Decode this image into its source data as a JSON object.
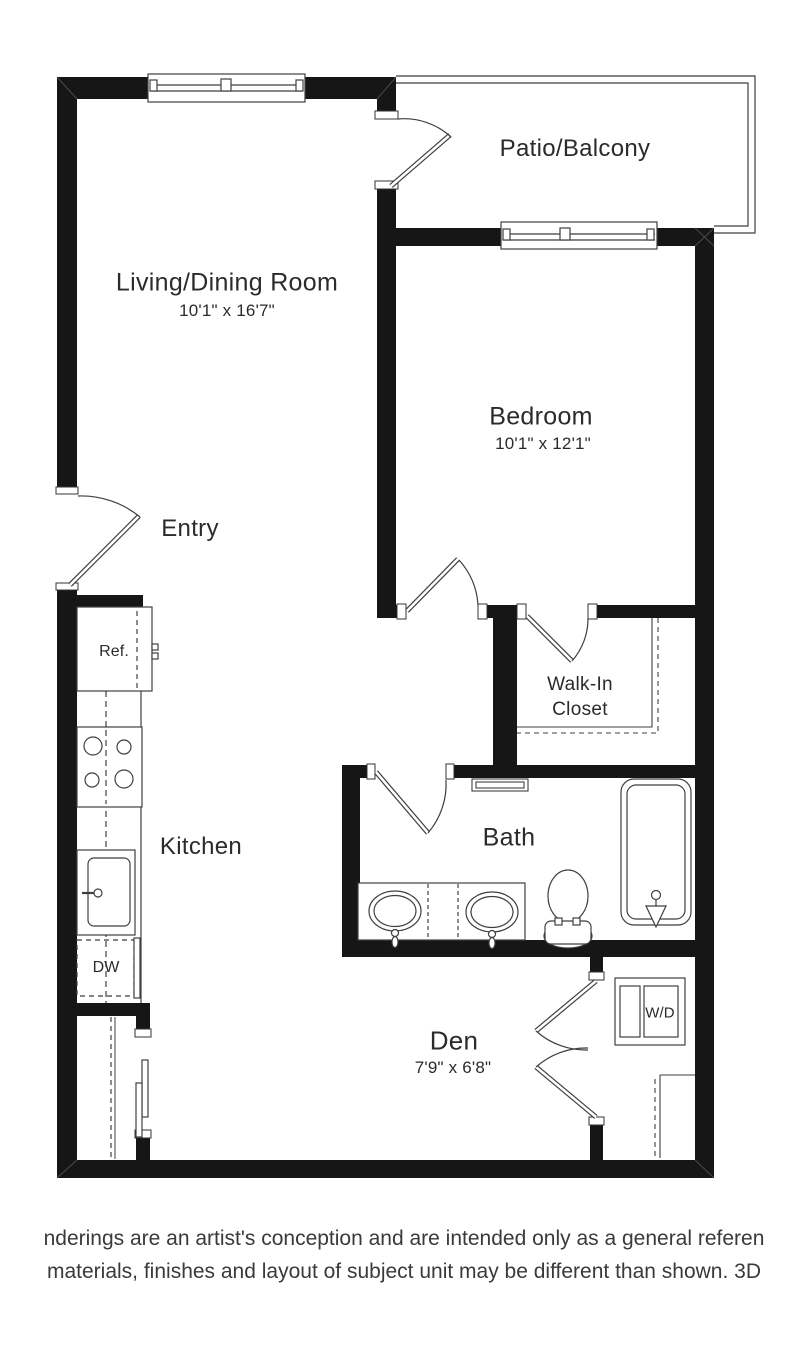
{
  "rooms": {
    "living_dining": {
      "label": "Living/Dining Room",
      "dims": "10'1\" x 16'7\""
    },
    "patio": {
      "label": "Patio/Balcony"
    },
    "bedroom": {
      "label": "Bedroom",
      "dims": "10'1\" x 12'1\""
    },
    "entry": {
      "label": "Entry"
    },
    "kitchen": {
      "label": "Kitchen"
    },
    "walk_in_closet": {
      "line1": "Walk-In",
      "line2": "Closet"
    },
    "bath": {
      "label": "Bath"
    },
    "den": {
      "label": "Den",
      "dims": "7'9\" x 6'8\""
    }
  },
  "appliances": {
    "refrigerator": "Ref.",
    "dishwasher": "DW",
    "washer_dryer": "W/D"
  },
  "disclaimer": {
    "line1": "nderings are an artist's conception and are intended only as a general referen",
    "line2": "materials, finishes and layout of subject unit may be different than shown. 3D"
  },
  "colors": {
    "wall": "#161616",
    "line": "#3f3f3f",
    "text": "#2b2b2b",
    "background": "#ffffff"
  }
}
